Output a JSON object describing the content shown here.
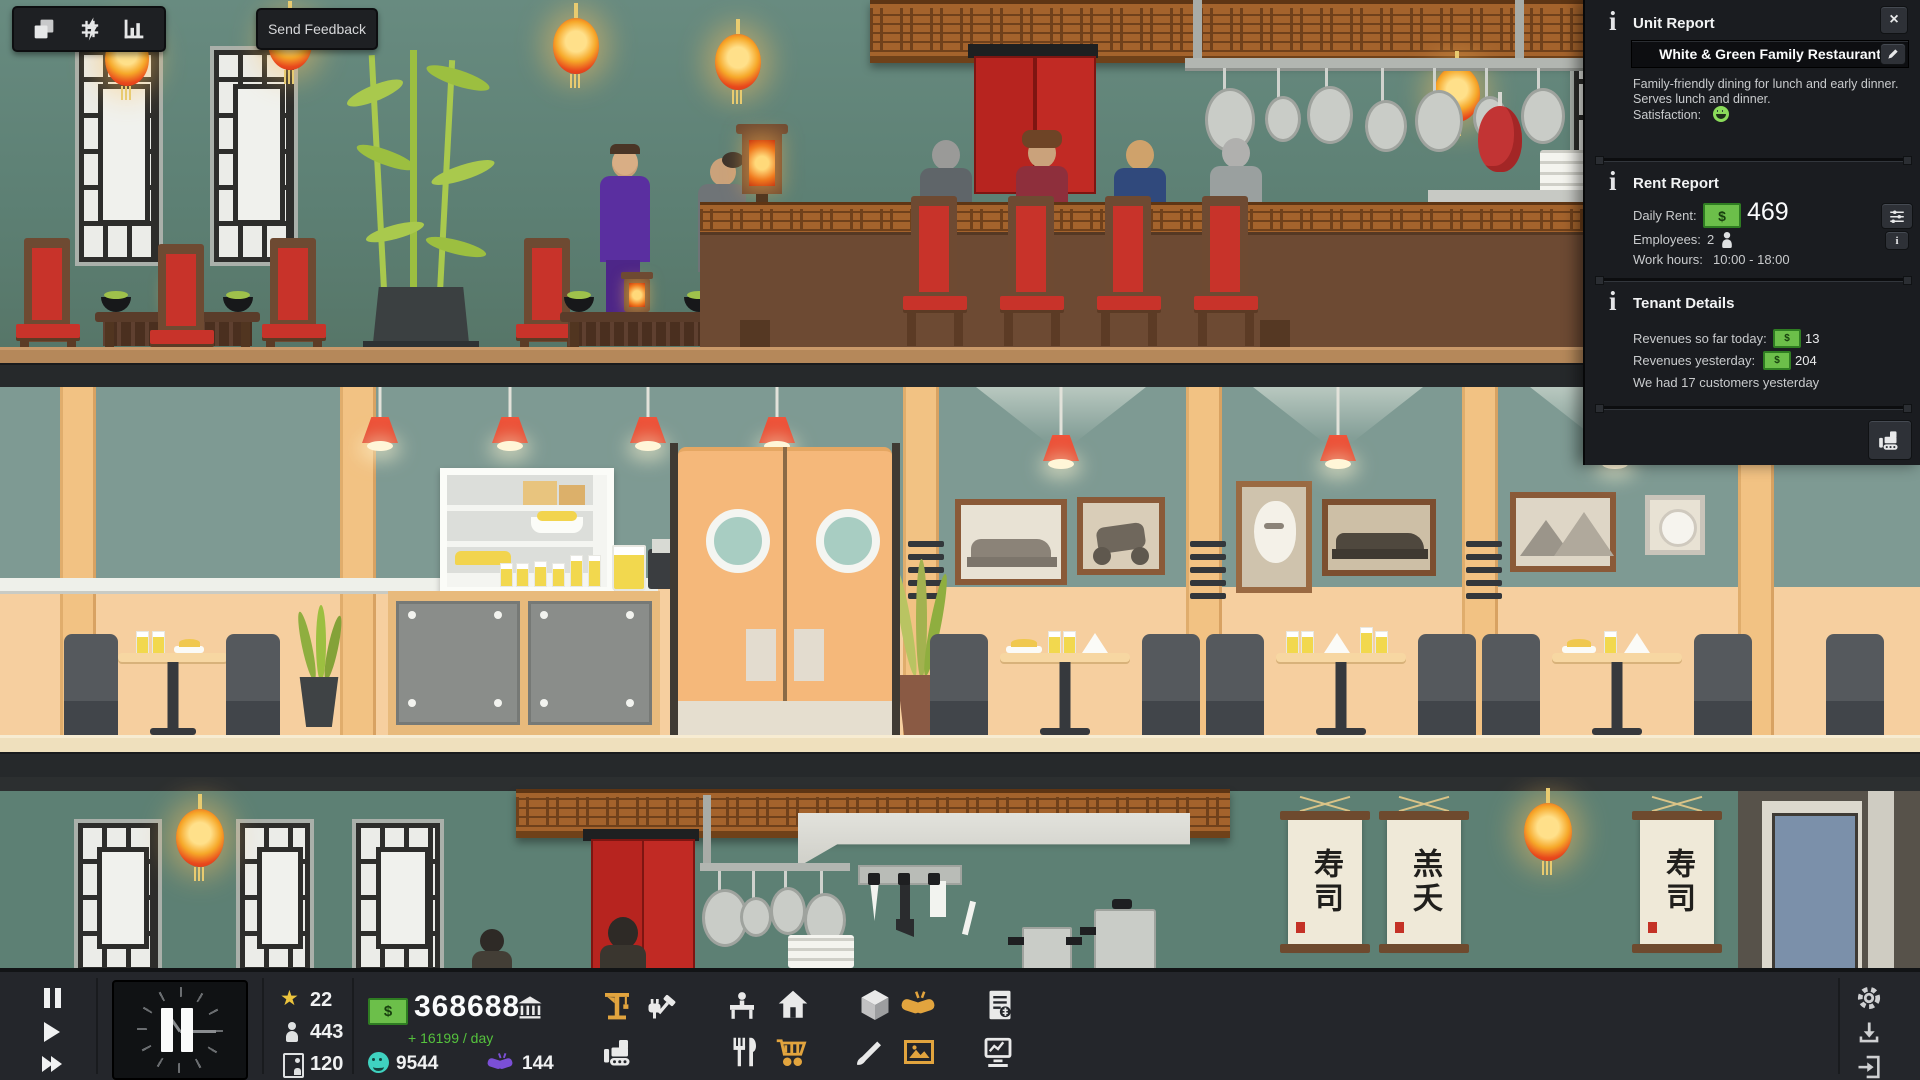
{
  "colors": {
    "accent_yellow": "#e2a43e",
    "money_green": "#6cbf4a",
    "income_green": "#55c23d",
    "satisfaction_green": "#8adb5a",
    "happiness_teal": "#3fd2c0",
    "deals_purple": "#7b4fd6",
    "lantern_red": "#e8481d"
  },
  "icons": {
    "close": "×",
    "star": "★",
    "dollar": "$",
    "info": "i"
  },
  "top_toolbar": {
    "send_feedback_label": "Send Feedback"
  },
  "unit_panel": {
    "title": "Unit Report",
    "unit_name": "White & Green Family Restaurant",
    "description_line1": "Family-friendly dining for lunch and early dinner.",
    "description_line2": "Serves lunch and dinner.",
    "satisfaction_label": "Satisfaction:",
    "rent_report": {
      "title": "Rent Report",
      "daily_rent_label": "Daily Rent:",
      "daily_rent_value": "469",
      "employees_label": "Employees:",
      "employees_value": "2",
      "work_hours_label": "Work hours:",
      "work_hours_value": "10:00 - 18:00"
    },
    "tenant_details": {
      "title": "Tenant Details",
      "revenues_today_label": "Revenues so far today:",
      "revenues_today_value": "13",
      "revenues_yesterday_label": "Revenues yesterday:",
      "revenues_yesterday_value": "204",
      "customers_line": "We had 17 customers yesterday"
    }
  },
  "hud": {
    "star_count": "22",
    "population_count": "443",
    "worker_count": "120",
    "money_balance": "368688",
    "income_per_day": "+ 16199 / day",
    "happiness_value": "9544",
    "deals_value": "144"
  },
  "scene": {
    "scroll_texts": [
      "寿司",
      "羔夭",
      "寿司"
    ]
  }
}
